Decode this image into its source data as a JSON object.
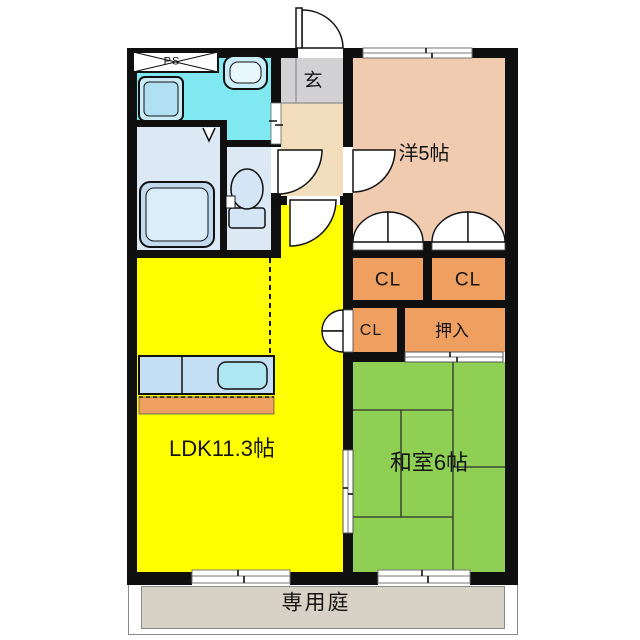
{
  "title": "2LDK apartment floor plan",
  "labels": {
    "ldk": "LDK11.3帖",
    "japanese_room": "和室6帖",
    "western_room": "洋5帖",
    "entrance": "玄",
    "closet_a": "CL",
    "closet_b": "CL",
    "closet_c": "CL",
    "oshiire": "押入",
    "private_garden": "専用庭",
    "pipe_space": "PS"
  },
  "colors": {
    "wall": "#0f0f0f",
    "ldk": "#ffff00",
    "japanese-room": "#8fd054",
    "western-room": "#f1cbb0",
    "closet": "#ef9f5f",
    "washroom": "#7fe8f0",
    "bathroom": "#dce9f5",
    "entrance": "#d2d2d4",
    "hallway": "#f2debc",
    "garden": "#d8d1c5",
    "fixture-blue": "#c5dff5",
    "sink-blue": "#aee6f2"
  }
}
